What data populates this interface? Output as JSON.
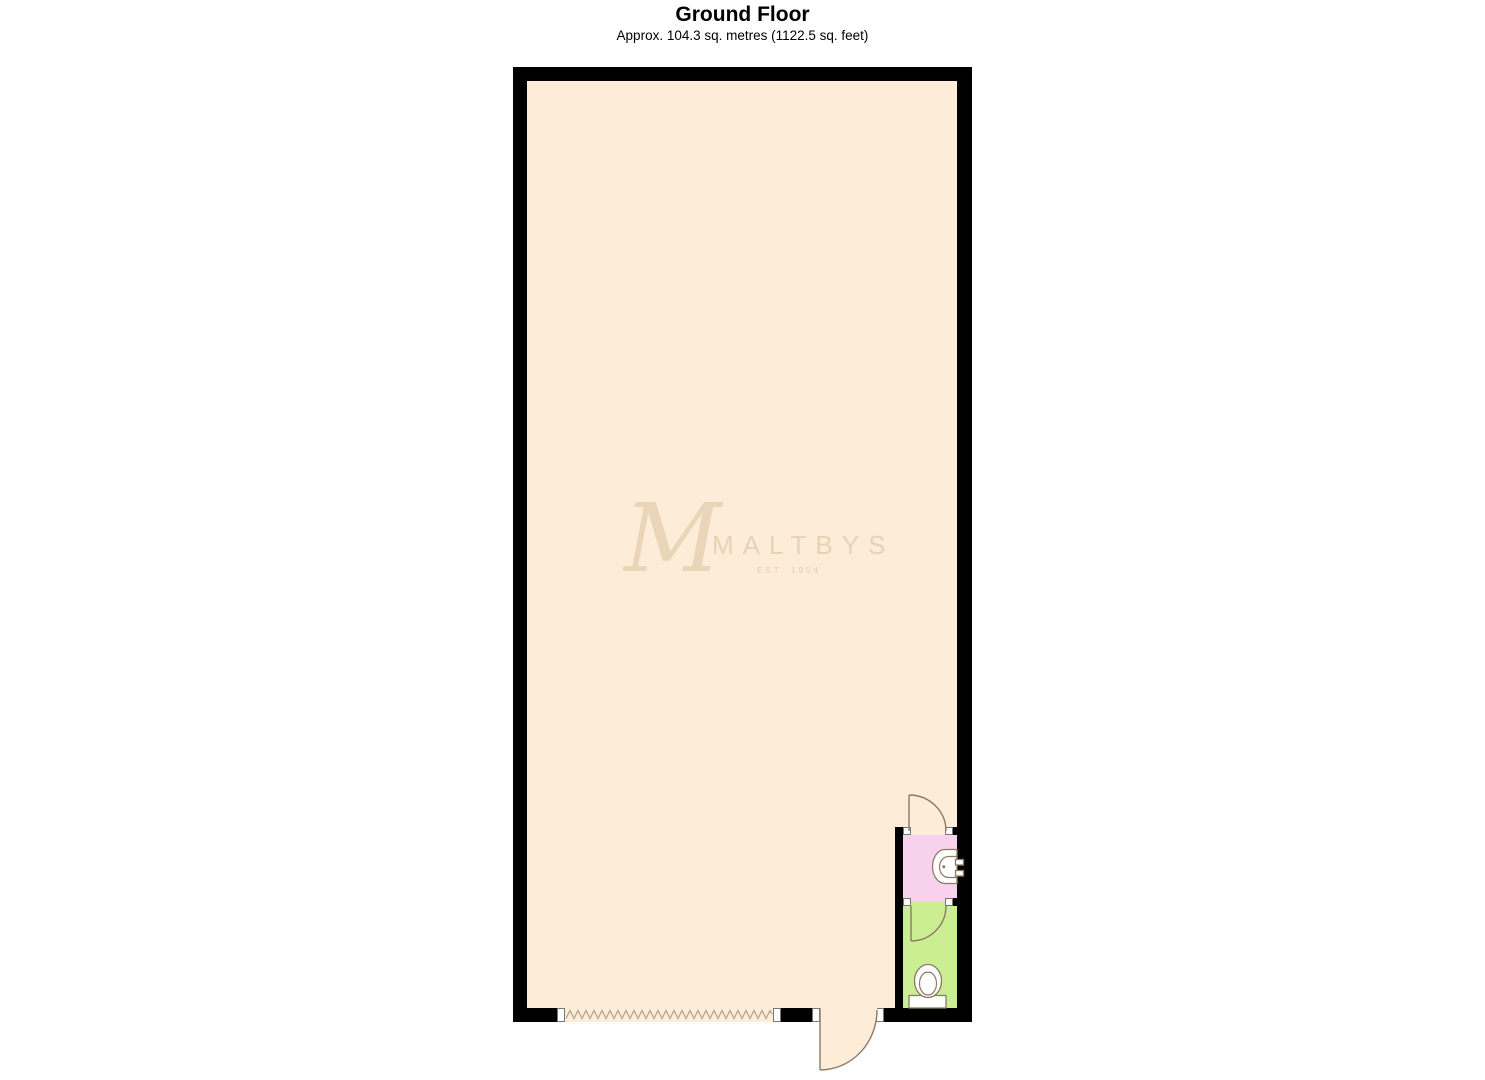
{
  "header": {
    "title": "Ground Floor",
    "subtitle": "Approx. 104.3 sq. metres (1122.5 sq. feet)"
  },
  "watermark": {
    "monogram": "M",
    "name": "MALTBYS",
    "tagline": "EST. 1904"
  },
  "floorplan": {
    "wall_color": "#000000",
    "outline_color": "#8c7b64",
    "window_symbol_color": "#b2a491",
    "rooms": [
      {
        "name": "main-area",
        "floor_color": "#fcecd8",
        "fixtures": []
      },
      {
        "name": "basin-room",
        "floor_color": "#f8d2ec",
        "fixtures": [
          "wash-basin"
        ]
      },
      {
        "name": "wc-room",
        "floor_color": "#cbee93",
        "fixtures": [
          "toilet"
        ]
      }
    ],
    "doors": [
      "main-entrance-door",
      "basin-room-door",
      "wc-room-door"
    ],
    "window": "zigzag-opening-symbol"
  }
}
